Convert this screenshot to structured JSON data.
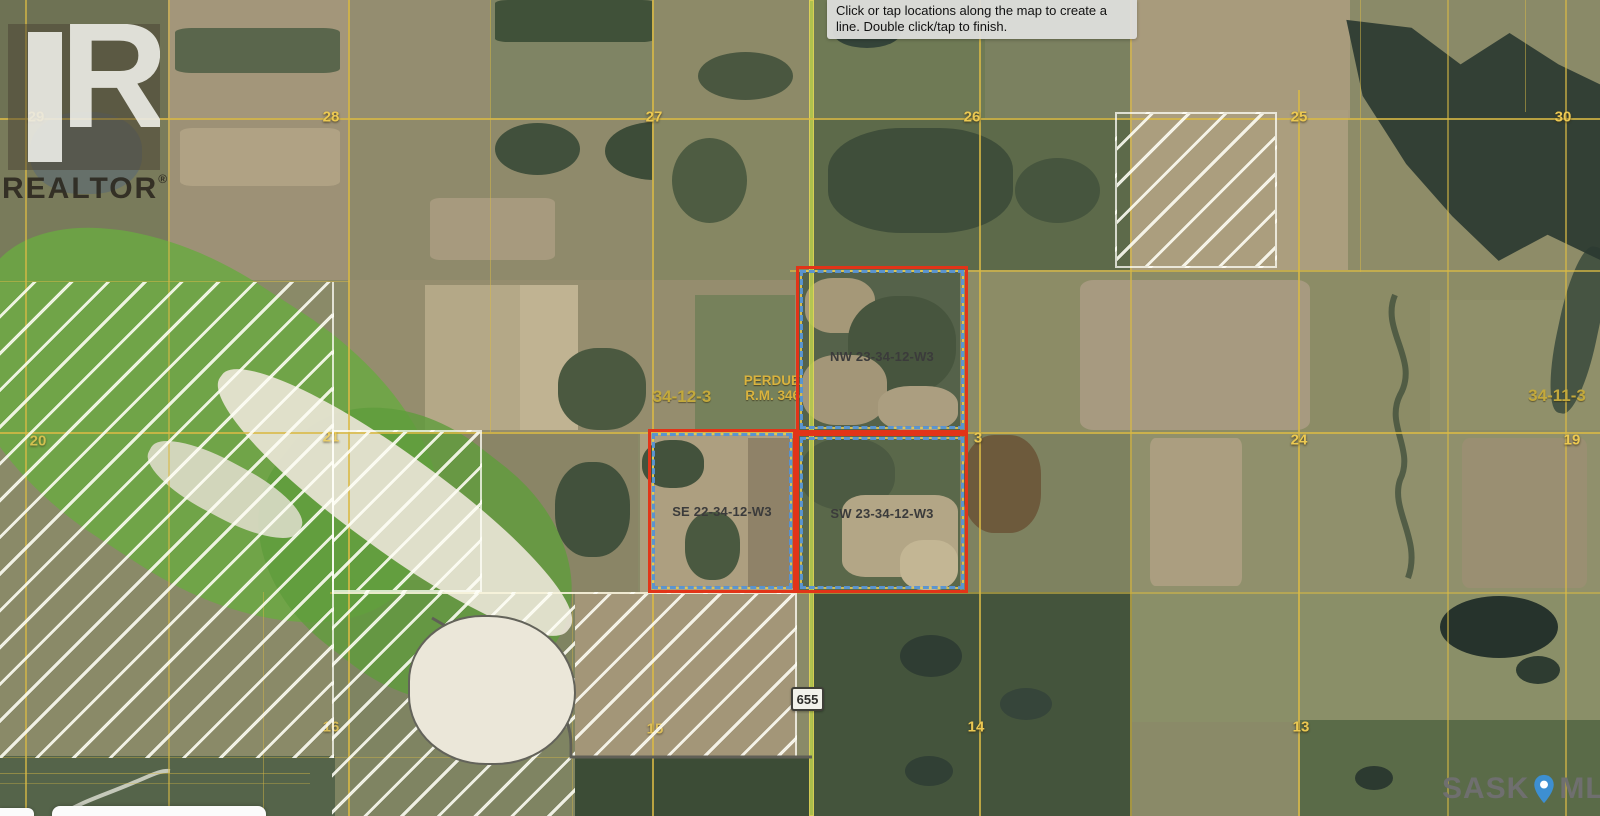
{
  "tooltip": {
    "line1": "Click or tap locations along the map to create a",
    "line2": "line. Double click/tap to finish."
  },
  "logo": {
    "letter": "R",
    "name": "REALTOR",
    "reg": "®"
  },
  "parcels": {
    "nw": {
      "label": "NW 23-34-12-W3"
    },
    "se": {
      "label": "SE 22-34-12-W3"
    },
    "sw": {
      "label": "SW 23-34-12-W3"
    },
    "outline_color": "#e23418",
    "dash_color": "#5593d6"
  },
  "municipality": {
    "name": "PERDUE",
    "rm": "R.M. 346"
  },
  "township_labels": [
    {
      "text": "34-12-3",
      "x": 682,
      "y": 397
    },
    {
      "text": "34-11-3",
      "x": 1557,
      "y": 396
    }
  ],
  "section_numbers": [
    {
      "text": "29",
      "x": 36,
      "y": 117,
      "dim": false
    },
    {
      "text": "28",
      "x": 331,
      "y": 117,
      "dim": false
    },
    {
      "text": "27",
      "x": 654,
      "y": 117,
      "dim": false
    },
    {
      "text": "26",
      "x": 972,
      "y": 117,
      "dim": false
    },
    {
      "text": "25",
      "x": 1299,
      "y": 117,
      "dim": false
    },
    {
      "text": "30",
      "x": 1563,
      "y": 117,
      "dim": false
    },
    {
      "text": "20",
      "x": 38,
      "y": 441,
      "dim": true
    },
    {
      "text": "21",
      "x": 331,
      "y": 437,
      "dim": true
    },
    {
      "text": "3",
      "x": 978,
      "y": 438,
      "dim": false
    },
    {
      "text": "24",
      "x": 1299,
      "y": 440,
      "dim": false
    },
    {
      "text": "19",
      "x": 1572,
      "y": 440,
      "dim": false
    },
    {
      "text": "16",
      "x": 331,
      "y": 727,
      "dim": true
    },
    {
      "text": "15",
      "x": 655,
      "y": 729,
      "dim": true
    },
    {
      "text": "14",
      "x": 976,
      "y": 727,
      "dim": false
    },
    {
      "text": "13",
      "x": 1301,
      "y": 727,
      "dim": false
    }
  ],
  "highway": {
    "number": "655"
  },
  "watermark": {
    "left": "SASK",
    "right": "MLS",
    "reg": "®",
    "pin_color": "#3d8fd1"
  },
  "grid_color": "#d9b945"
}
